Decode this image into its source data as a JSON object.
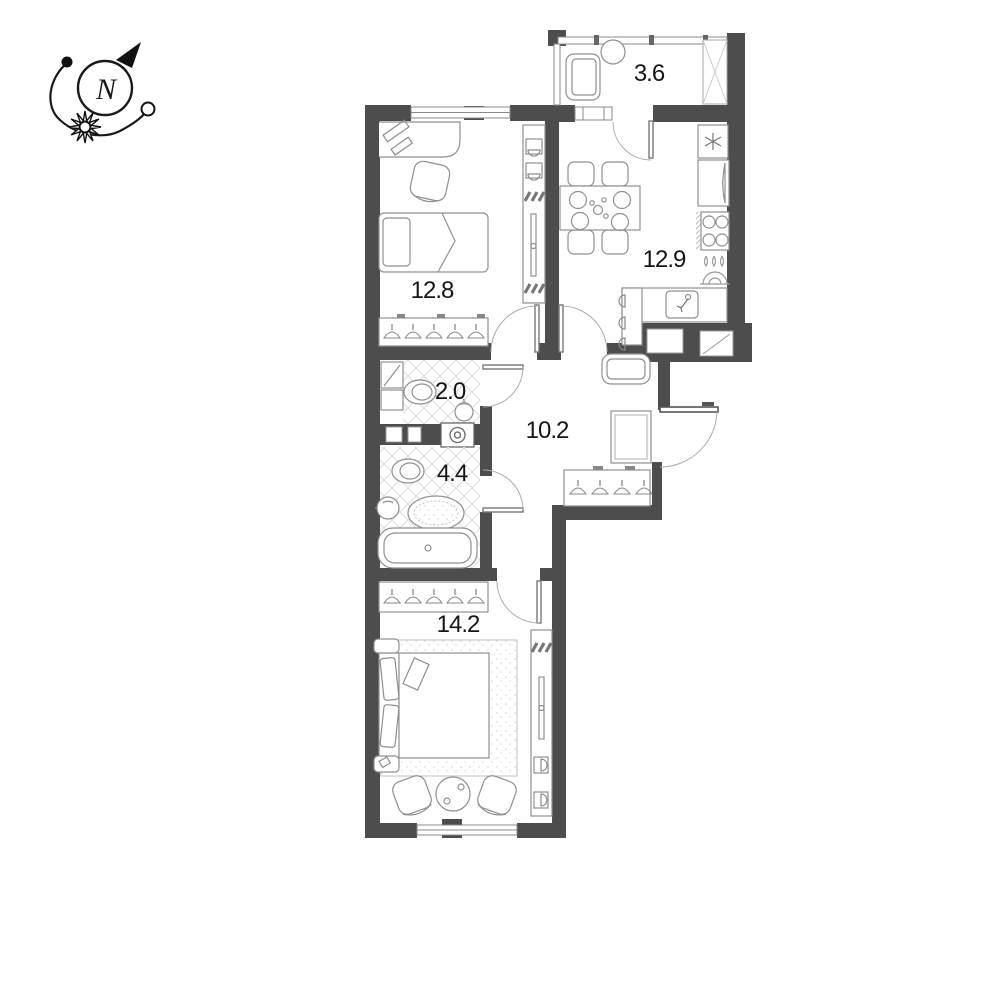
{
  "page": {
    "background": "#ffffff"
  },
  "compass": {
    "label": "N"
  },
  "colors": {
    "wall": "#4d4d4d",
    "furniture_line": "#8f8f8f",
    "label_text": "#161616",
    "compass_line": "#1a1a1a"
  },
  "rooms": [
    {
      "id": "balcony",
      "area": "3.6"
    },
    {
      "id": "bedroom-1",
      "area": "12.8"
    },
    {
      "id": "kitchen",
      "area": "12.9"
    },
    {
      "id": "wc",
      "area": "2.0"
    },
    {
      "id": "hallway",
      "area": "10.2"
    },
    {
      "id": "bathroom",
      "area": "4.4"
    },
    {
      "id": "bedroom-2",
      "area": "14.2"
    }
  ]
}
